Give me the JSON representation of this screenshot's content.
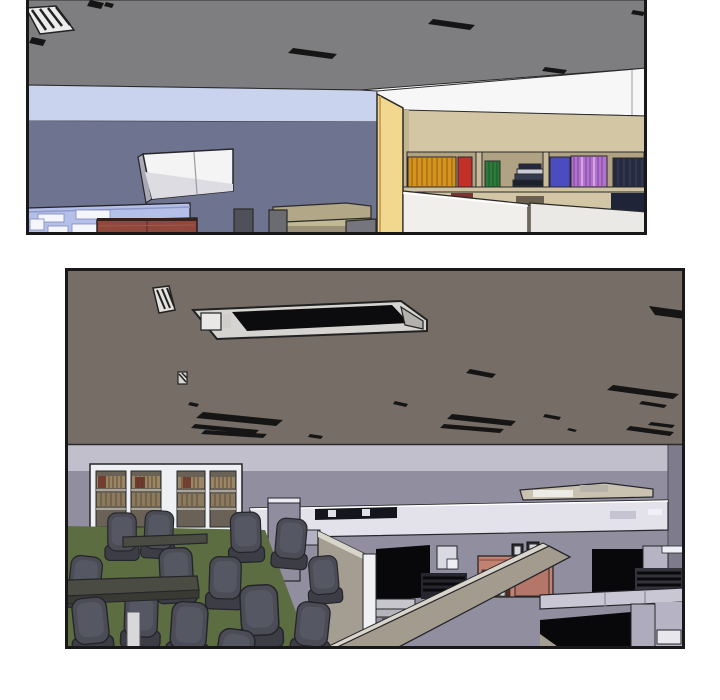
{
  "page": {
    "background": "#ffffff",
    "kind": "webtoon-comic-page",
    "panel_count": 2
  },
  "panels": [
    {
      "name": "panel-top",
      "description": "3D-rendered office interior, upper panel: gray ceiling with dark vents and a hatched light fixture, light-blue clerestory band, slate-blue wall, white whiteboard partition, periwinkle cabinet with white labels, brick-red sideboard, olive couch, yellow pillar and tan bookshelf filled with orange, red, green, blue, violet and navy books above white cubicle partitions"
    },
    {
      "name": "panel-bottom",
      "description": "3D-rendered office interior, lower panel: dark taupe ceiling with a large recessed light and scattered vents, lavender wall with white-framed glass binder cabinets, meeting area of dark office chairs and tables on green carpet, cubicle farm with taupe and white partitions, salmon cabinet with books and picture frames, black desk openings"
    }
  ],
  "colors": {
    "border": "#18181a",
    "p1_ceiling": "#7e7e80",
    "p1_skylight": "#c9d3ee",
    "p1_wall": "#6e7390",
    "p1_white_wall": "#f7f7f7",
    "p1_pillar": "#f1d88e",
    "p1_shelf": "#d3c6a4",
    "p1_shelf_recess": "#b0a383",
    "p1_partition": "#f0efec",
    "p1_partition2": "#eae9e6",
    "p1_book_orange": "#d4941e",
    "p1_book_red": "#c23028",
    "p1_book_green": "#2e7a3e",
    "p1_book_blue": "#4a4cc0",
    "p1_book_violet": "#b273cc",
    "p1_book_navy": "#252a40",
    "p1_whiteboard": "#f4f4f4",
    "p1_cabinet_blue": "#b5c0e8",
    "p1_sideboard_red": "#8e483c",
    "p1_couch_olive": "#b2a887",
    "p1_couch_gray": "#6b6b72",
    "p1_desk_gray": "#c6c6ca",
    "p1_vent_black": "#151515",
    "p2_ceiling": "#756d66",
    "p2_light_band": "#c1bfcc",
    "p2_wall": "#908e9f",
    "p2_wall_corner": "#7e7c8c",
    "p2_carpet": "#5d6d42",
    "p2_cabinet_frame": "#eff0f4",
    "p2_glass": "#6b6257",
    "p2_binder_tan": "#9a8565",
    "p2_binder_tan2": "#8a7a5e",
    "p2_cubicle_white": "#e3e2ea",
    "p2_cubicle_lavender": "#8f8d9e",
    "p2_partition_taupe": "#a49d91",
    "p2_partition_face": "#a29b8e",
    "p2_partition_top": "#d9d5cb",
    "p2_rail": "#c9c7d4",
    "p2_monitor_black": "#15151c",
    "p2_cubby_black": "#08080a",
    "p2_salmon": "#c28272",
    "p2_counter_tan": "#c9c2b0",
    "p2_chair": "#4b4c55",
    "p2_chair_seat": "#3c3d45",
    "p2_chair_hi": "#555763",
    "p2_table": "#4a4b42",
    "p2_pedestal": "#d8d8da",
    "p2_fixture_frame": "#d6d4d0",
    "p2_fixture_black": "#0c0c0e",
    "p2_vent_black": "#151515"
  }
}
